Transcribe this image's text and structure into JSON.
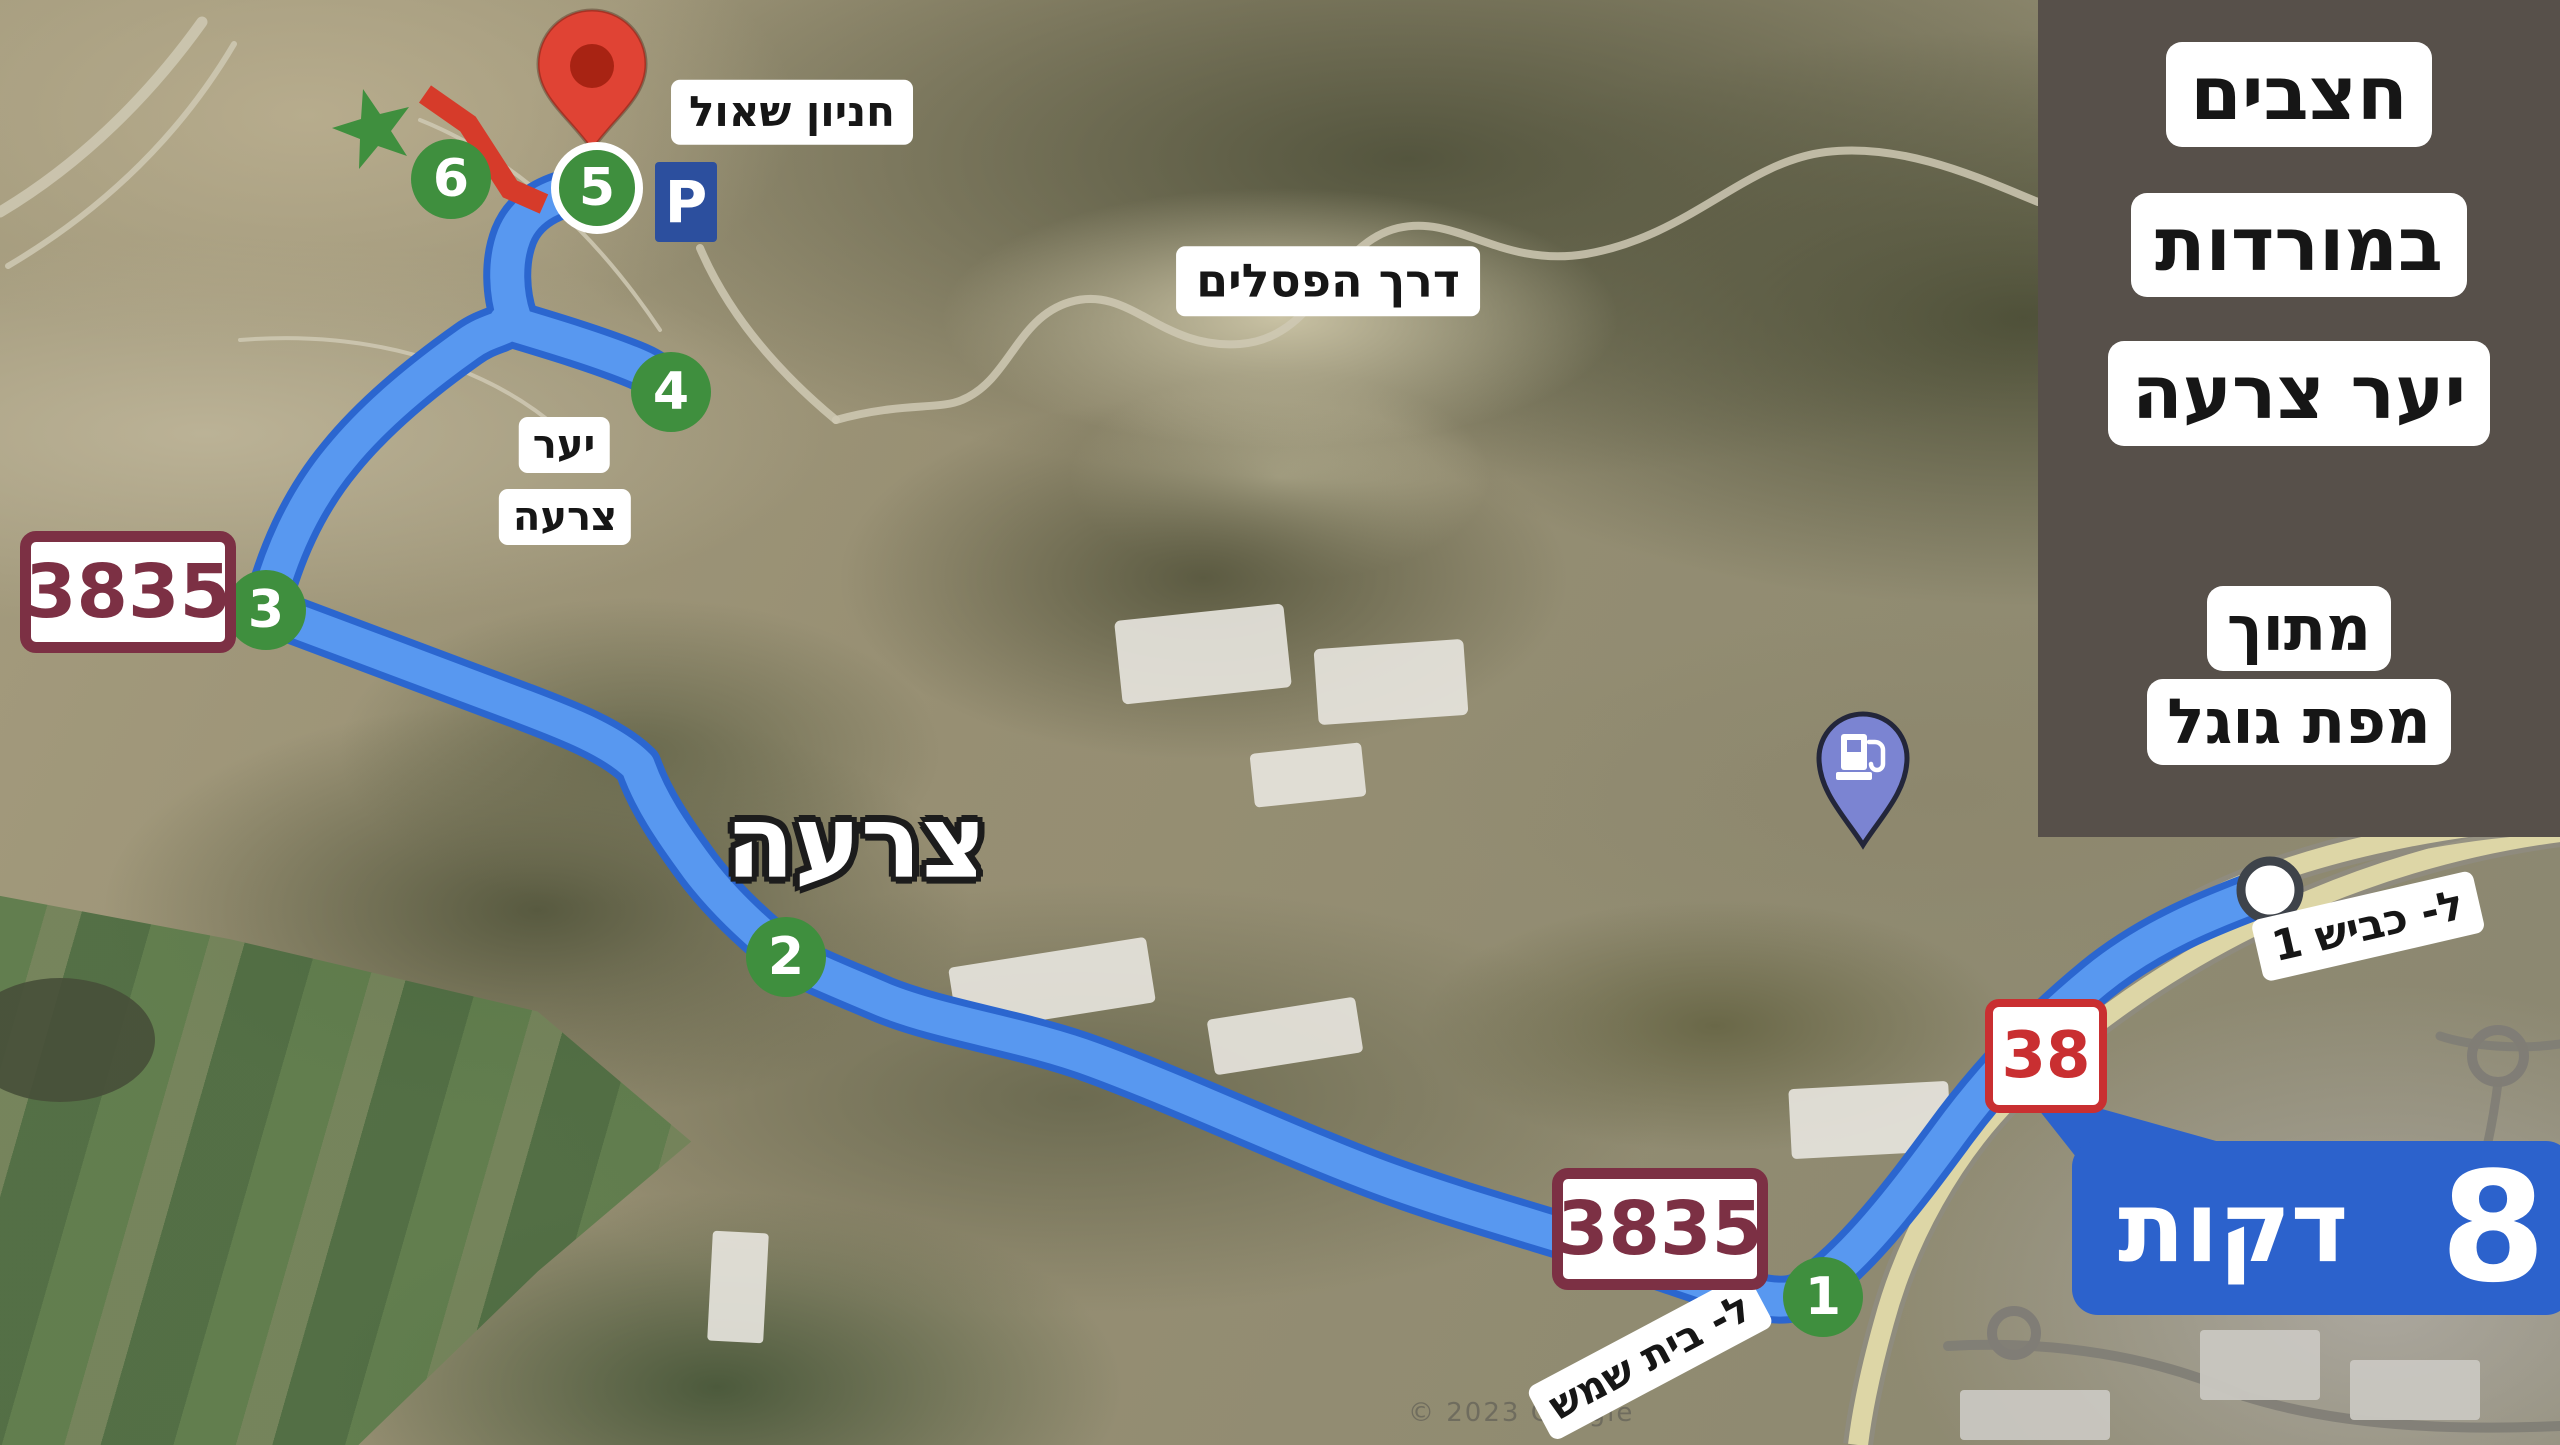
{
  "colors": {
    "route_fill": "#5898f0",
    "route_casing": "#2b66cf",
    "marker_green": "#3f8f3e",
    "trail_red": "#d63b2a",
    "pin_red": "#e04334",
    "pin_red_inner": "#a82313",
    "banner_blue": "#2c62cc",
    "parking_blue": "#2c4f9e",
    "shield_maroon": "#7c3044",
    "shield_red": "#c92f31",
    "panel_brown": "#57504a",
    "gas_purple": "#7b84d2"
  },
  "title_panel": {
    "line1": "חצבים",
    "line2": "במורדות",
    "line3": "יער צרעה",
    "source1": "מתוך",
    "source2": "מפת גוגל"
  },
  "duration_banner": {
    "value": "8",
    "unit": "דקות"
  },
  "map_labels": {
    "shaul_parking": "חניון שאול",
    "sculptures_road": "דרך הפסלים",
    "forest_word": "יער",
    "forest_name": "צרעה",
    "city": "צרעה",
    "to_road_1": "ל- כביש 1",
    "to_beit_shemesh": "ל- בית שמש",
    "parking_letter": "P",
    "watermark": "© 2023 Google"
  },
  "road_shields": {
    "west_3835": "3835",
    "south_3835": "3835",
    "road_38": "38"
  },
  "route_stops": {
    "s1": "1",
    "s2": "2",
    "s3": "3",
    "s4": "4",
    "s5": "5",
    "s6": "6"
  },
  "icons": {
    "destination_pin": "red-map-pin",
    "gas_station": "fuel-station-pin",
    "star_marker": "green-star",
    "steps_marker": "red-zigzag-trail",
    "route_start": "white-circle"
  }
}
